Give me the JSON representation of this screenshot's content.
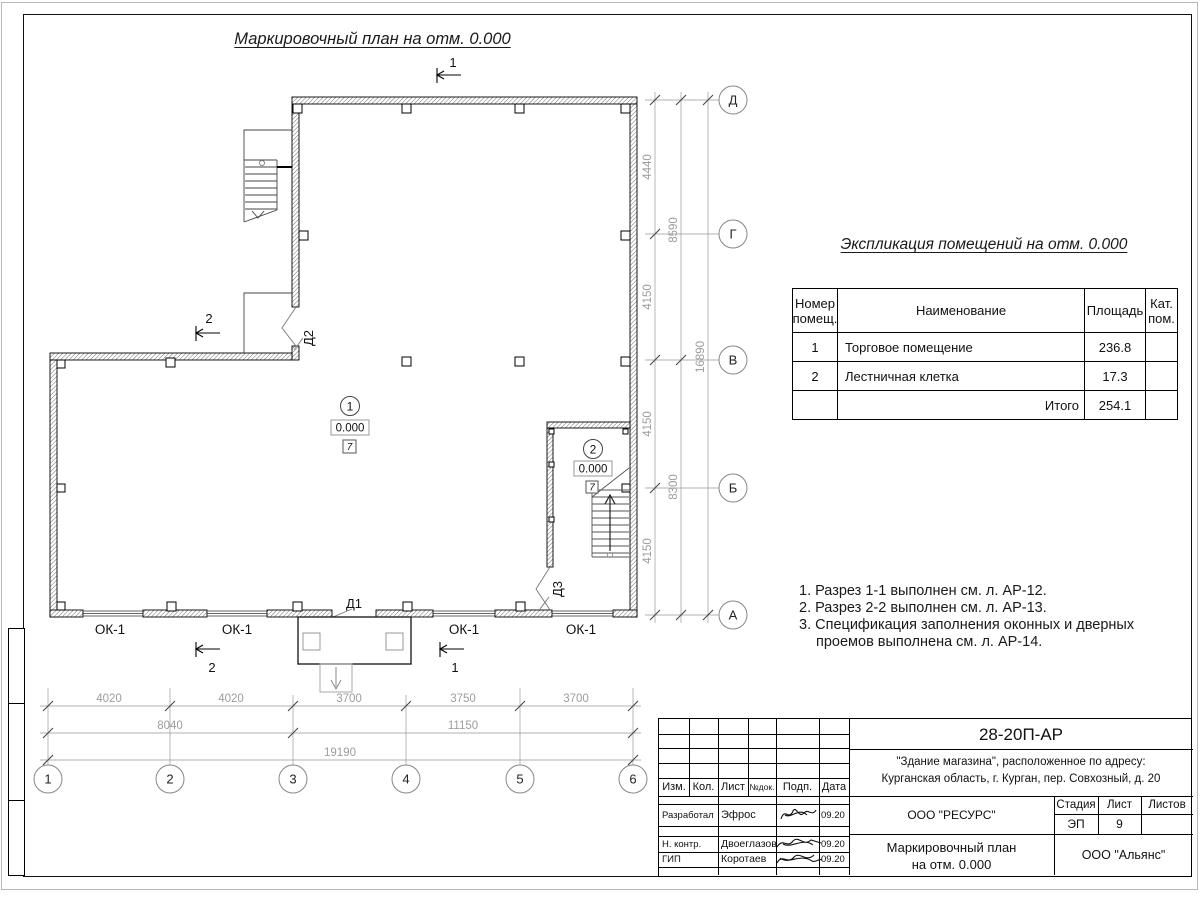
{
  "sheet": {
    "title": "Маркировочный план на отм. 0.000"
  },
  "plan": {
    "marker1": "1",
    "marker2": "2",
    "door_d1": "Д1",
    "door_d2": "Д2",
    "door_d3": "Д3",
    "window_label": "ОК-1",
    "room1": {
      "number": "1",
      "elevation": "0.000",
      "cat": "7"
    },
    "room2": {
      "number": "2",
      "elevation": "0.000",
      "cat": "7"
    },
    "axes_bottom": [
      "1",
      "2",
      "3",
      "4",
      "5",
      "6"
    ],
    "axes_right": [
      "Д",
      "Г",
      "В",
      "Б",
      "А"
    ],
    "dims_bottom": {
      "chain1": [
        "4020",
        "4020",
        "3700",
        "3750",
        "3700"
      ],
      "chain2": [
        "8040",
        "11150"
      ],
      "chain3": [
        "19190"
      ]
    },
    "dims_right": {
      "chain1": [
        "4440",
        "4150",
        "4150",
        "4150"
      ],
      "chain2": [
        "8590",
        "8300"
      ],
      "chain3": [
        "16890"
      ]
    }
  },
  "explication": {
    "title": "Экспликация помещений на отм. 0.000",
    "col_num": "Номер помещ.",
    "col_name": "Наименование",
    "col_area": "Площадь",
    "col_cat": "Кат. пом.",
    "rows": [
      {
        "num": "1",
        "name": "Торговое помещение",
        "area": "236.8",
        "cat": ""
      },
      {
        "num": "2",
        "name": "Лестничная клетка",
        "area": "17.3",
        "cat": ""
      }
    ],
    "total_label": "Итого",
    "total_area": "254.1"
  },
  "notes": {
    "line1": "1. Разрез 1-1 выполнен см. л. АР-12.",
    "line2": "2. Разрез 2-2 выполнен см. л. АР-13.",
    "line3": "3. Спецификация заполнения оконных и дверных",
    "line4": "проемов выполнена см. л. АР-14."
  },
  "titleblock": {
    "doc_code": "28-20П-АР",
    "object_line1": "\"Здание магазина\", расположенное по адресу:",
    "object_line2": "Курганская область, г. Курган, пер. Совхозный, д. 20",
    "col_izm": "Изм.",
    "col_kol": "Кол.",
    "col_list": "Лист",
    "col_ndok": "№док.",
    "col_podp": "Подп.",
    "col_data": "Дата",
    "row_dev_role": "Разработал",
    "row_dev_name": "Эфрос",
    "row_dev_date": "09.20",
    "row_ncontr_role": "Н. контр.",
    "row_ncontr_name": "Двоеглазов",
    "row_ncontr_date": "09.20",
    "row_gip_role": "ГИП",
    "row_gip_name": "Коротаев",
    "row_gip_date": "09.20",
    "org_designer": "ООО \"РЕСУРС\"",
    "stage_label": "Стадия",
    "sheet_label": "Лист",
    "sheets_label": "Листов",
    "stage_value": "ЭП",
    "sheet_value": "9",
    "drawing_title1": "Маркировочный план",
    "drawing_title2": "на отм. 0.000",
    "org_customer": "ООО \"Альянс\""
  }
}
